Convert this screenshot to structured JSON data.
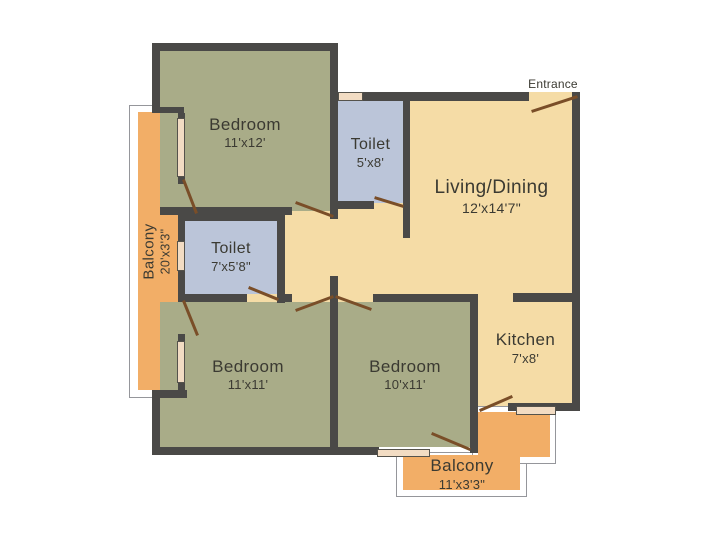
{
  "plan": {
    "title": "Apartment floor plan",
    "entrance_label": "Entrance",
    "colors": {
      "wall": "#4a4947",
      "bedroom_fill": "#a9ac88",
      "toilet_fill": "#bbc5d9",
      "living_fill": "#f5dca6",
      "balcony_fill": "#f2ae67",
      "door_swing": "#7a4e28",
      "window_sill": "#f2dcc3",
      "label_text": "#3b3a32"
    },
    "rooms": {
      "bedroom_top": {
        "name": "Bedroom",
        "dims": "11'x12'"
      },
      "toilet_top": {
        "name": "Toilet",
        "dims": "5'x8'"
      },
      "living": {
        "name": "Living/Dining",
        "dims": "12'x14'7\""
      },
      "toilet_mid": {
        "name": "Toilet",
        "dims": "7'x5'8\""
      },
      "bedroom_left": {
        "name": "Bedroom",
        "dims": "11'x11'"
      },
      "bedroom_mid": {
        "name": "Bedroom",
        "dims": "10'x11'"
      },
      "kitchen": {
        "name": "Kitchen",
        "dims": "7'x8'"
      },
      "balcony_left": {
        "name": "Balcony",
        "dims": "20'x3'3\""
      },
      "balcony_bottom": {
        "name": "Balcony",
        "dims": "11'x3'3\""
      }
    }
  }
}
